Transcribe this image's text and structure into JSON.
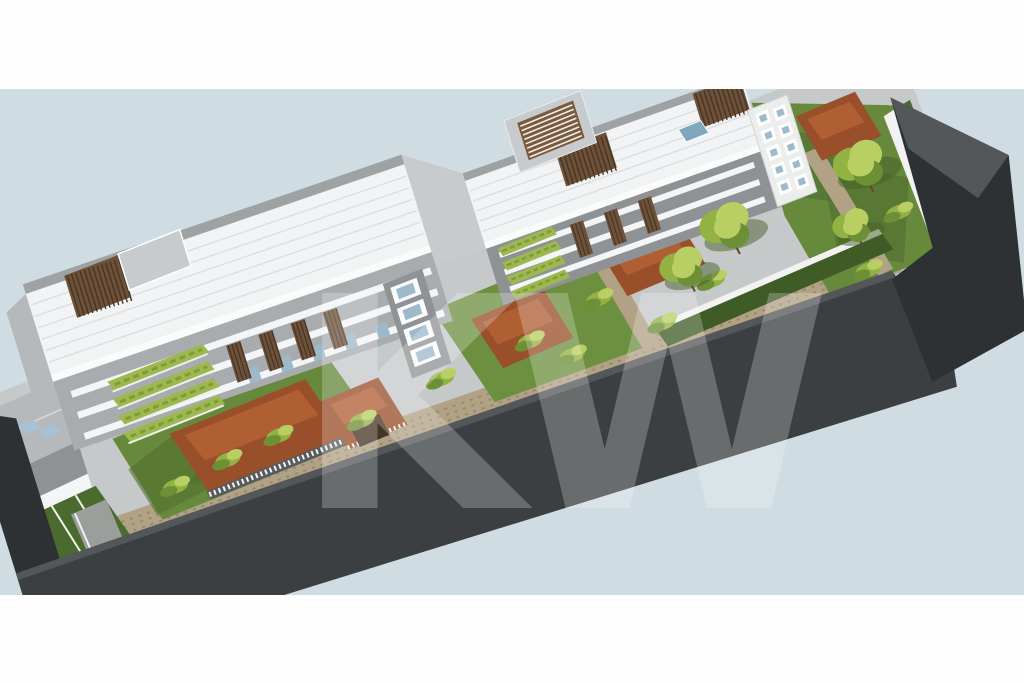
{
  "image": {
    "kind": "3d-architectural-rendering",
    "view": "aerial axonometric view of an elongated residential condominium complex on a diagonal site",
    "background": "pale blue backdrop with white horizontal bands at top and bottom"
  },
  "watermark": {
    "text": "KW"
  },
  "palette": {
    "margin": "#fefefe",
    "sky": "#cfdde2",
    "ground": "#c6c9ca",
    "dark1": "#2e3133",
    "dark2": "#3c3f41",
    "dark3": "#54575a",
    "roofWhite": "#f2f3f4",
    "roofRib": "#dcdedf",
    "roofTrim": "#9fa2a4",
    "fascia": "#fafbfb",
    "gableGray": "#b6b9bb",
    "wallLight": "#c8cbcd",
    "wallMid": "#a9acae",
    "wallDark": "#8f9294",
    "towerGray": "#909395",
    "towerWhite": "#eceeee",
    "slabWhite": "#f4f5f6",
    "glassBlue": "#9db9ca",
    "skylightBlue": "#a8c2d4",
    "poolBlue": "#7fa8bd",
    "slatBrown": "#6e5139",
    "slatDark": "#463526",
    "louverBrown": "#7a5a3e",
    "terracotta": "#9a4f2b",
    "terracottaLight": "#b05f33",
    "terracottaDark": "#7e3f22",
    "lawn": "#66893c",
    "lawnDark": "#4a6a2e",
    "lawnShade": "#52702f",
    "lawnBright": "#6d9040",
    "hedge": "#3f5c26",
    "planter": "#9db84e",
    "planterDark": "#7f9c3a",
    "foliage": "#93b244",
    "foliageLight": "#b9cf63",
    "foliageDark": "#6d8f35",
    "treeShadow": "#44602a",
    "trunk": "#5d4a33",
    "path": "#b1a285",
    "pathSpeckle": "#97896c",
    "whiteWall": "#f2f2f2",
    "slatFence": "#585b5d",
    "ramp": "#9b9e9b",
    "watermark": "#ffffff"
  },
  "scene": {
    "features": [
      "two long white ribbed pitched roofs",
      "rooftop wooden slat pergolas",
      "central stair penthouse with brown louvers",
      "white balcony slabs with glass doors",
      "stacked framed windows on stair towers",
      "stepped green roof planters",
      "terracotta terrace roofs with white slat railings",
      "private lawns and shrubs",
      "two courtyard trees and right-end garden trees",
      "tan gravel paths",
      "dark charcoal perimeter walls",
      "gray annex building with skylights at left end"
    ]
  }
}
